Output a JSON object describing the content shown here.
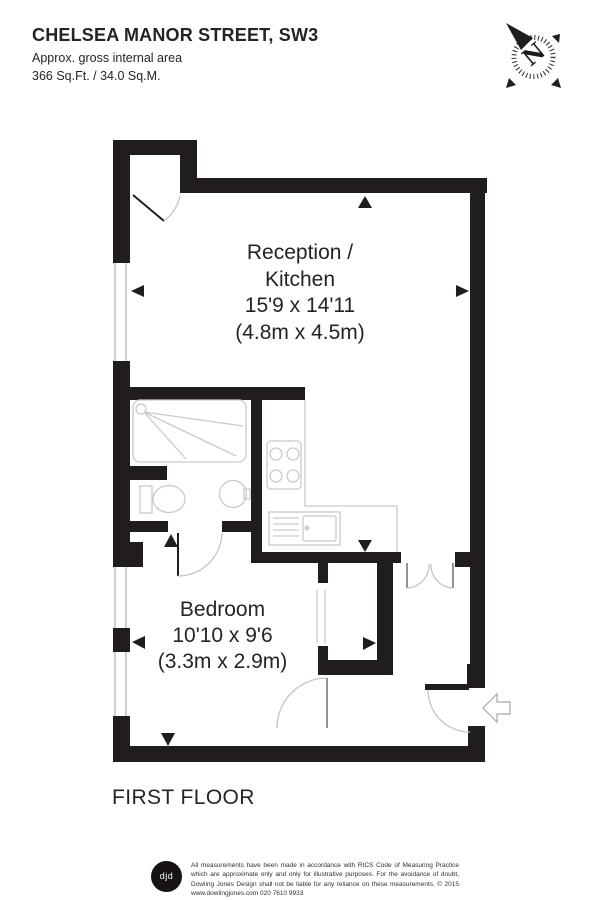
{
  "header": {
    "title": "CHELSEA MANOR STREET, SW3",
    "subtitle": "Approx. gross internal area",
    "area": "366 Sq.Ft. / 34.0 Sq.M."
  },
  "compass": {
    "label": "N"
  },
  "rooms": {
    "reception_kitchen": {
      "label_line1": "Reception /",
      "label_line2": "Kitchen",
      "dimensions_imperial": "15'9 x 14'11",
      "dimensions_metric": "(4.8m x 4.5m)"
    },
    "bedroom": {
      "label": "Bedroom",
      "dimensions_imperial": "10'10 x 9'6",
      "dimensions_metric": "(3.3m x 2.9m)"
    }
  },
  "floor_label": "FIRST FLOOR",
  "footer": {
    "logo_text": "djd",
    "disclaimer": "All measurements have been made in accordance with RICS Code of Measuring Practice which are approximate only and only for illustrative purposes. For the avoidance of doubt, Dowling Jones Design shall not be liable for any reliance on these measurements. © 2015 www.dowlingjones.com 020 7610 9933"
  },
  "colors": {
    "wall": "#211d1e",
    "fixture_outline": "#c9cacb",
    "door_swing": "#c4c5c6",
    "text": "#272324"
  }
}
